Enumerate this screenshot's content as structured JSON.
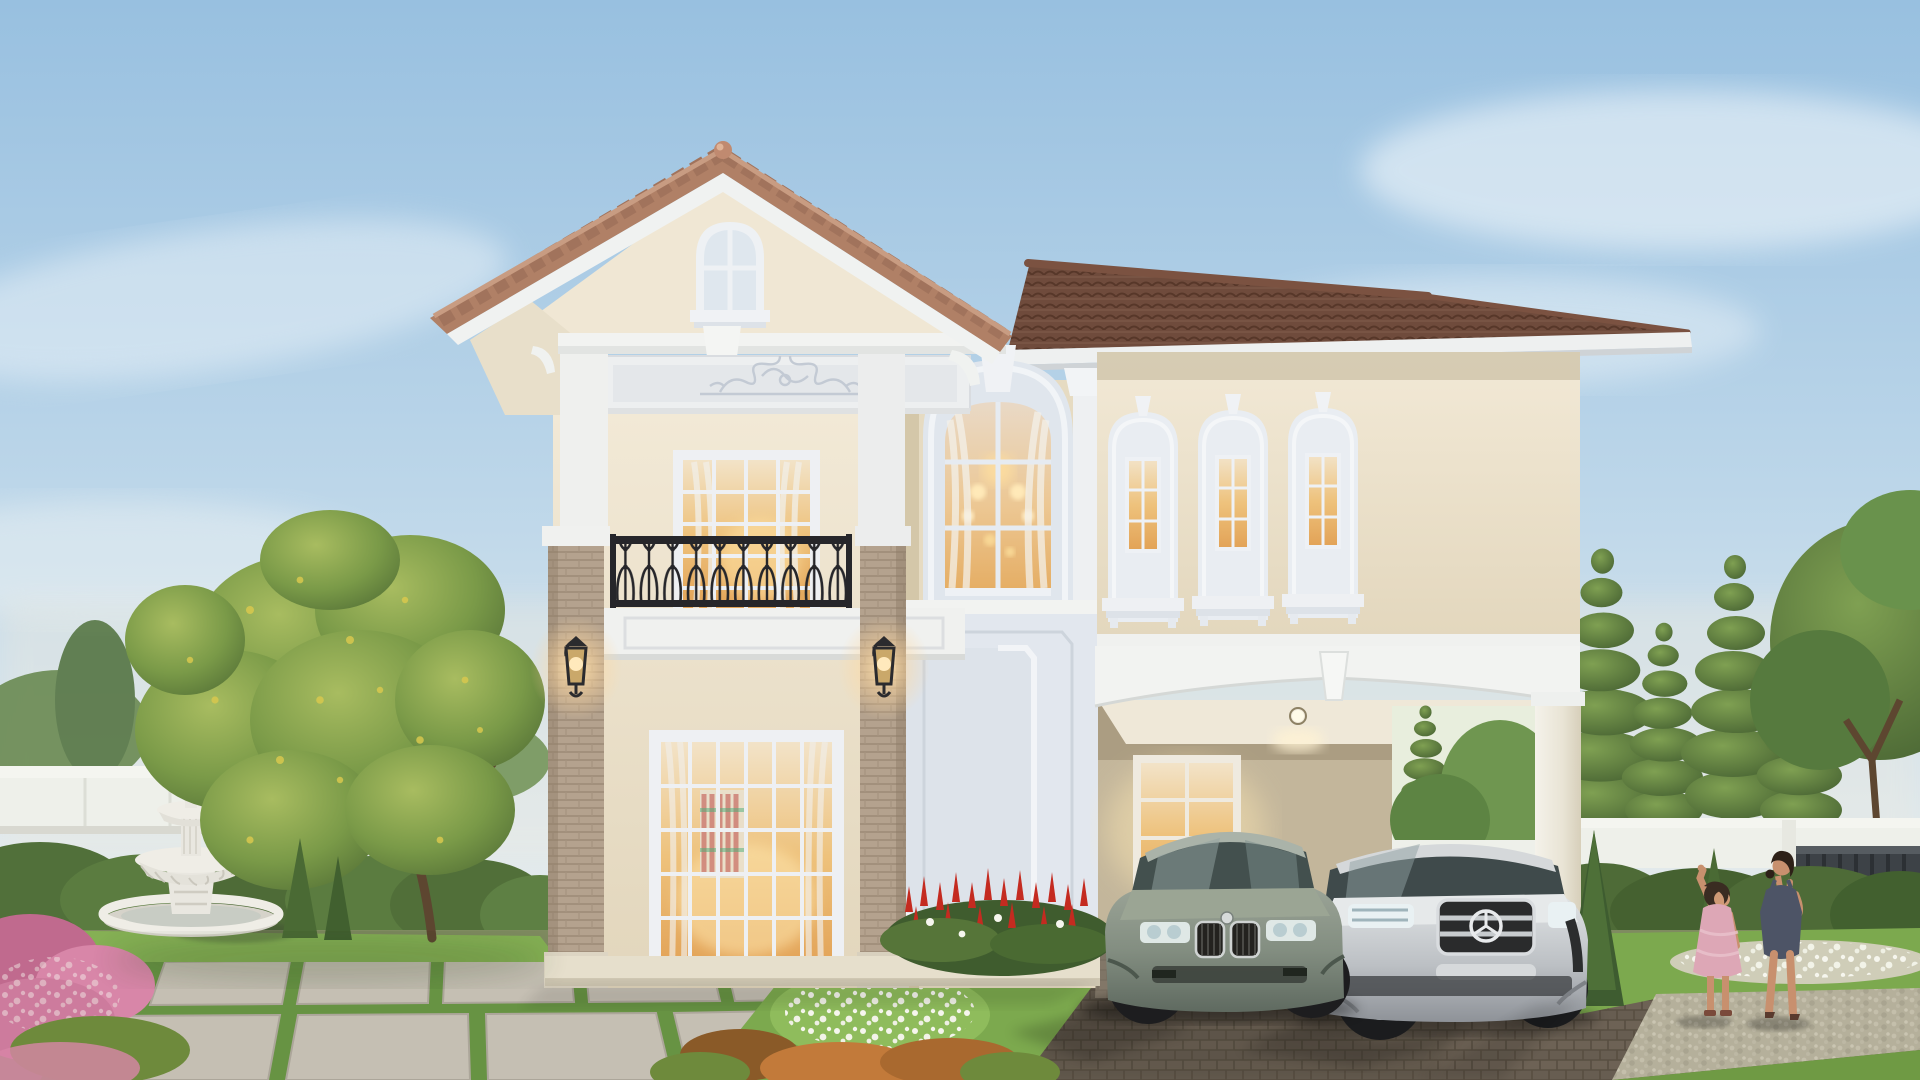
{
  "scene": {
    "type": "architectural-exterior-render",
    "description": "Two-story cream luxury house with gabled terracotta roof, balcony, tall arched window, triple arched windows, carport with two cars, landscaped garden, white fountain, perimeter wall, and a woman with a child at dusk lighting",
    "objects": [
      "sky",
      "clouds",
      "gable-roof",
      "main-hip-roof",
      "roof-finial",
      "gable-arched-window",
      "decorative-frieze",
      "balcony-window",
      "balcony-railing",
      "brick-pilasters",
      "wall-lanterns",
      "ground-floor-window",
      "tall-arched-window",
      "decorative-wall-panel",
      "triple-arched-windows",
      "carport",
      "carport-downlight",
      "carport-interior-window",
      "bmw-sedan",
      "mercedes-suv",
      "driveway-pavers",
      "stone-walkway",
      "garden-fountain",
      "perimeter-wall",
      "garden-gate",
      "hedges",
      "pine-trees",
      "leafy-tree",
      "red-flower-bed",
      "white-flower-lawn",
      "pink-flower-bushes",
      "topiary-cones",
      "pebble-path",
      "woman",
      "child"
    ]
  },
  "palette": {
    "sky_top": "#98c0e0",
    "sky_mid": "#c2d9ea",
    "sky_horizon": "#eeece0",
    "cloud_white": "#f7fafc",
    "wall_cream": "#efe6d2",
    "wall_cream_dark": "#d9cdb2",
    "wall_recess": "#e6dbc2",
    "trim_white": "#f2f3f1",
    "trim_cool": "#e3e8ee",
    "trim_shade": "#cfd6e0",
    "roof_gable": "#b08066",
    "roof_gable_hl": "#c89c82",
    "roof_main": "#6f4b3c",
    "roof_ridge": "#7b5241",
    "brick": "#b4a28e",
    "brick_line": "#9d8a76",
    "iron_black": "#26262a",
    "glass_warm": "#eec27c",
    "glass_warm_hi": "#f6e3bc",
    "glass_cool": "#dfe7ee",
    "lamp_glow": "#ffd89e",
    "driveway": "#786d5f",
    "driveway_dark": "#5c5245",
    "paver_light": "#c5bfb3",
    "pebble": "#b5b09b",
    "lawn": "#7ca94e",
    "lawn_bright": "#94bf60",
    "hedge": "#4e6b37",
    "tree_green": "#5f8140",
    "tree_yellow_green": "#9aae55",
    "pine_green": "#47663a",
    "flower_red": "#c42b20",
    "flower_pink": "#d886a8",
    "flower_white": "#f6f6ee",
    "shrub_orange": "#c27a3a",
    "fence_white": "#eef0ea",
    "gate_dark": "#3d4247",
    "fountain_white": "#eceae2",
    "car_bmw": "#8d978b",
    "car_bmw_dark": "#5f6a60",
    "car_merc": "#c7cacd",
    "car_merc_dark": "#8e9298",
    "skin": "#c8906e",
    "woman_dress": "#4d5466",
    "child_dress": "#dda7b6",
    "hair_dark": "#2e2118"
  }
}
